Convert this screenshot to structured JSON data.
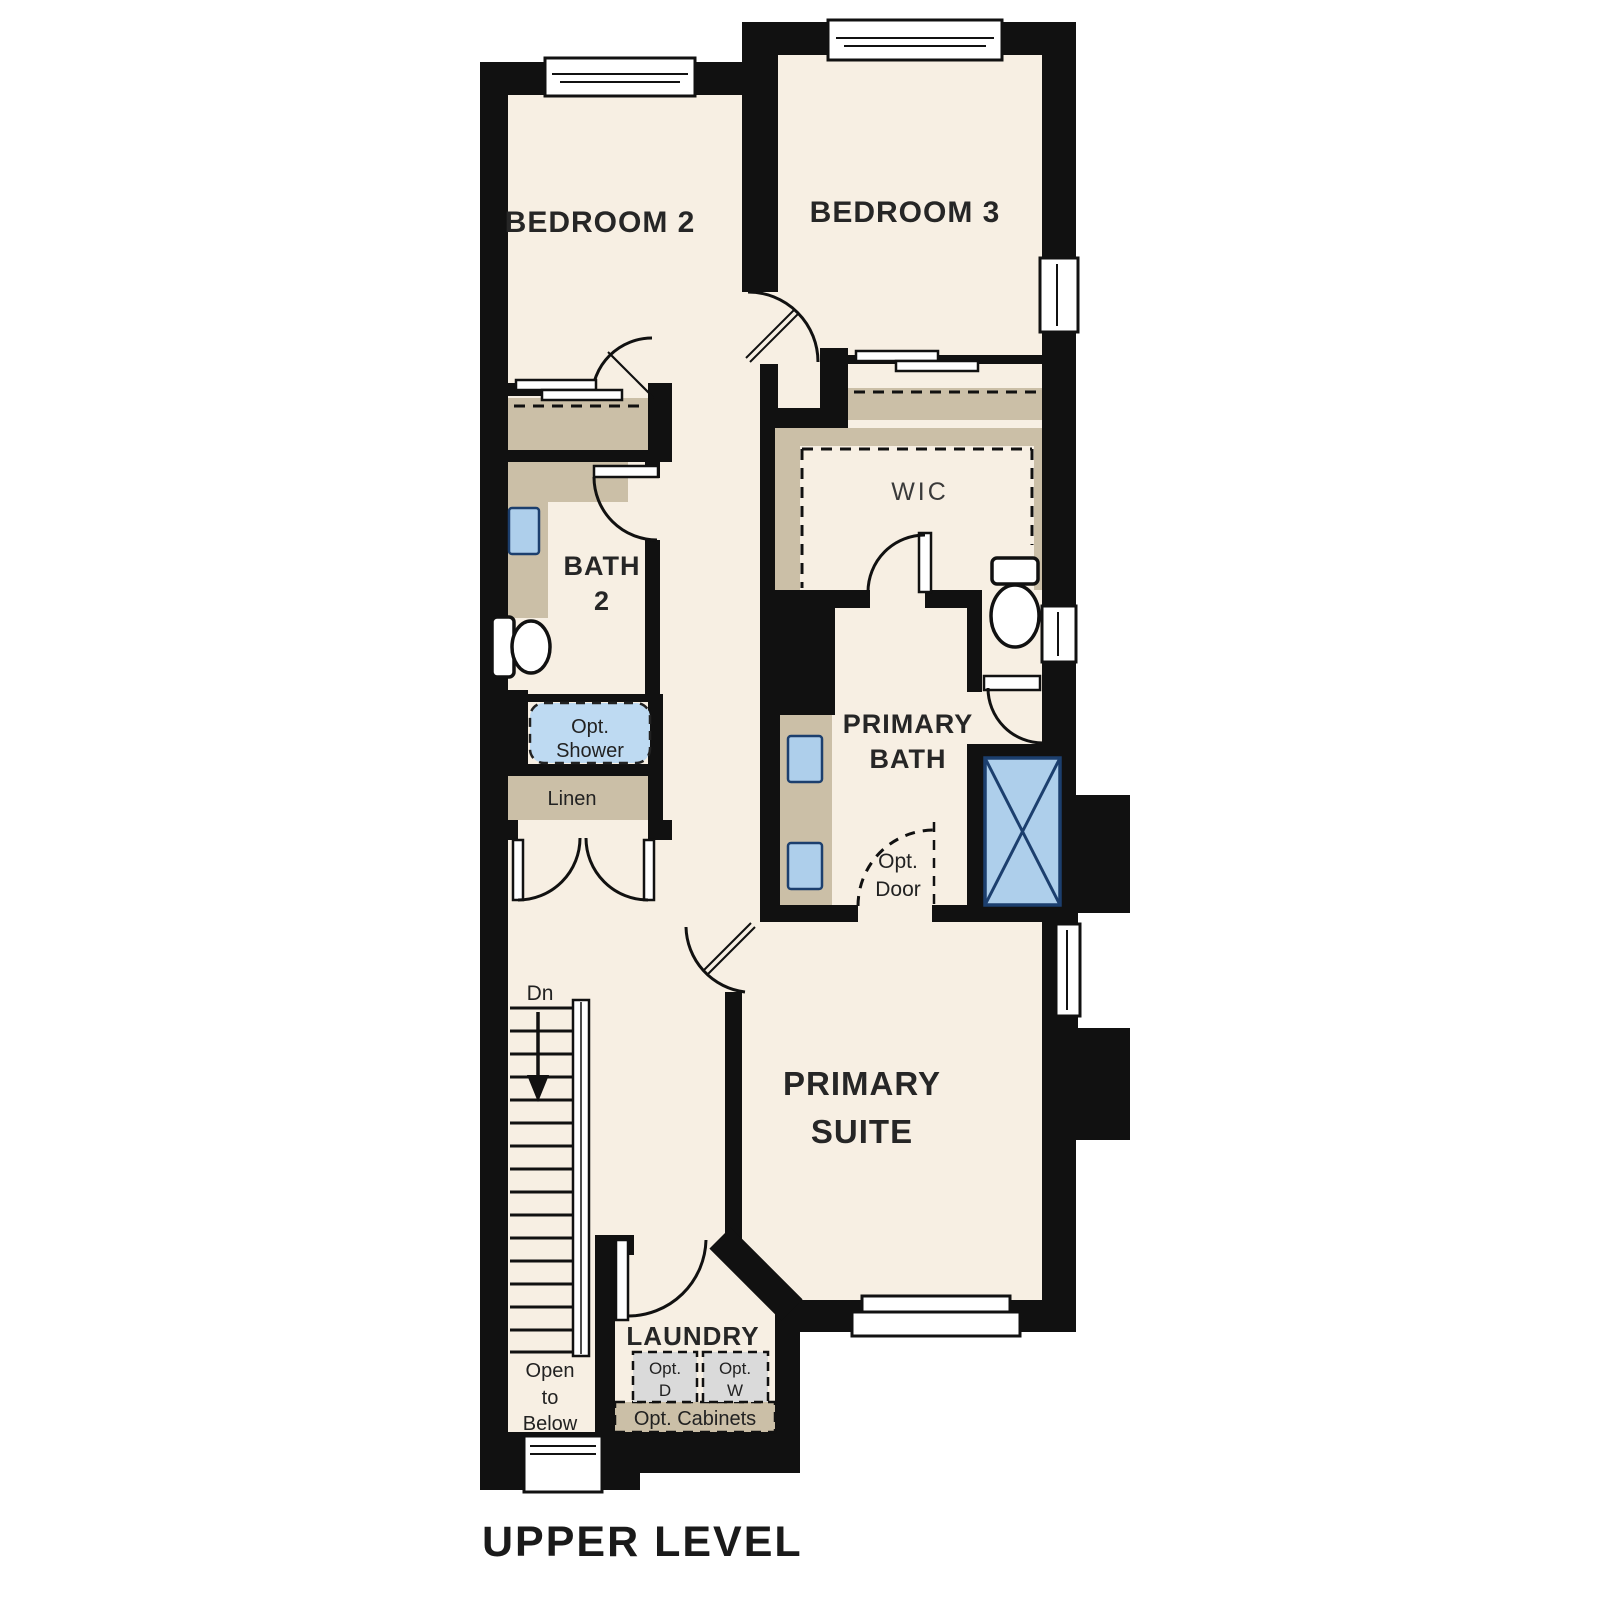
{
  "title": "UPPER LEVEL",
  "rooms": {
    "bedroom2": "BEDROOM 2",
    "bedroom3": "BEDROOM 3",
    "bath2_line1": "BATH",
    "bath2_line2": "2",
    "wic": "WIC",
    "primary_bath_line1": "PRIMARY",
    "primary_bath_line2": "BATH",
    "primary_suite_line1": "PRIMARY",
    "primary_suite_line2": "SUITE",
    "laundry": "LAUNDRY"
  },
  "annotations": {
    "opt_shower_line1": "Opt.",
    "opt_shower_line2": "Shower",
    "linen": "Linen",
    "stairs_down": "Dn",
    "open_below_line1": "Open",
    "open_below_line2": "to",
    "open_below_line3": "Below",
    "opt_dryer_line1": "Opt.",
    "opt_dryer_line2": "D",
    "opt_washer_line1": "Opt.",
    "opt_washer_line2": "W",
    "opt_cabinets": "Opt. Cabinets",
    "opt_door_line1": "Opt.",
    "opt_door_line2": "Door"
  },
  "colors": {
    "wall": "#111111",
    "floor": "#f7efe3",
    "closet_tan": "#cbbfa7",
    "fixture_blue": "#aecfeb",
    "opt_shower_blue": "#bedaf2",
    "fixture_outline_navy": "#1c3f6e",
    "appliance_gray": "#dadada"
  }
}
